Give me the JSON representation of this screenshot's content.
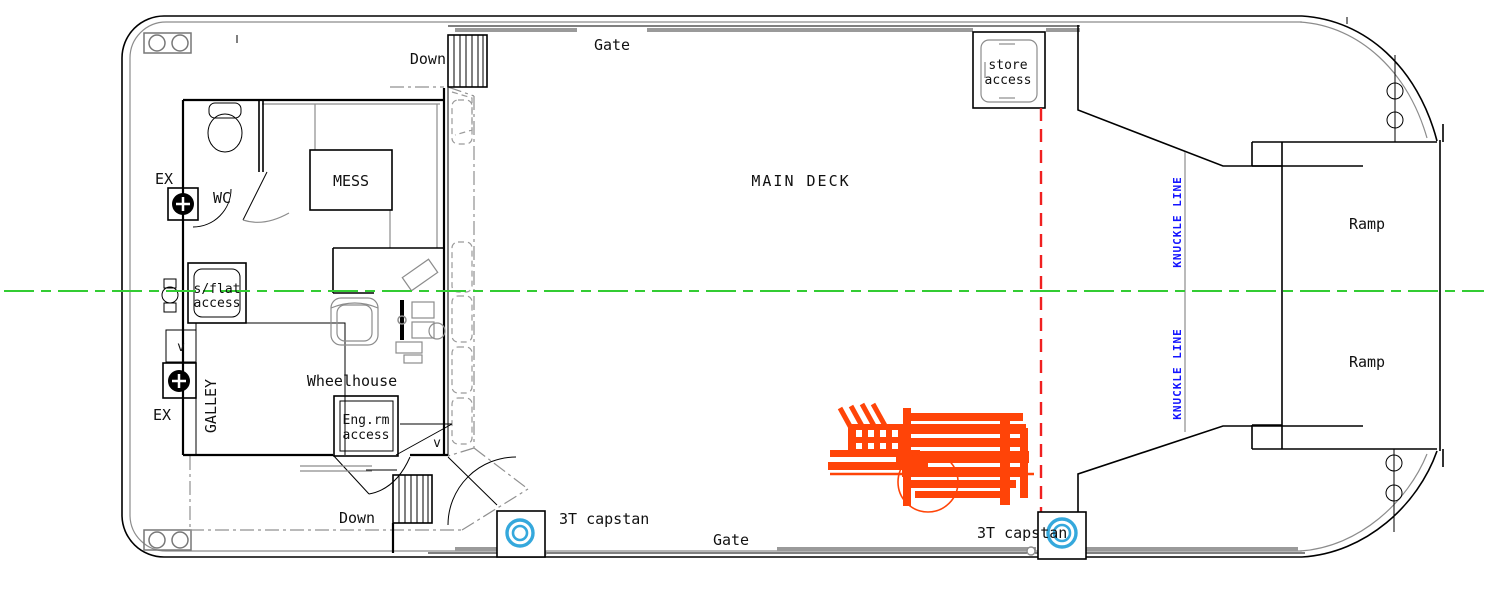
{
  "labels": {
    "down_top": "Down",
    "down_bottom": "Down",
    "gate_top": "Gate",
    "gate_bottom": "Gate",
    "main_deck": "MAIN DECK",
    "wc": "WC",
    "mess": "MESS",
    "galley": "GALLEY",
    "wheelhouse": "Wheelhouse",
    "sflat_line1": "s/flat",
    "sflat_line2": "access",
    "engrm_line1": "Eng.rm",
    "engrm_line2": "access",
    "store_line1": "store",
    "store_line2": "access",
    "ex_top": "EX",
    "ex_bottom": "EX",
    "v_left": "v",
    "v_right": "v",
    "ramp_top": "Ramp",
    "ramp_bottom": "Ramp",
    "capstan_left": "3T capstan",
    "capstan_right": "3T capstan",
    "knuckle_top": "KNUCKLE LINE",
    "knuckle_bottom": "KNUCKLE LINE"
  },
  "colors": {
    "line": "#000000",
    "secondary": "#8c8c8c",
    "centerline": "#33cc33",
    "hold_outline": "#f02020",
    "knuckle_text": "#1414ff",
    "capstan": "#35a8dc",
    "vehicle": "#ff4408"
  }
}
